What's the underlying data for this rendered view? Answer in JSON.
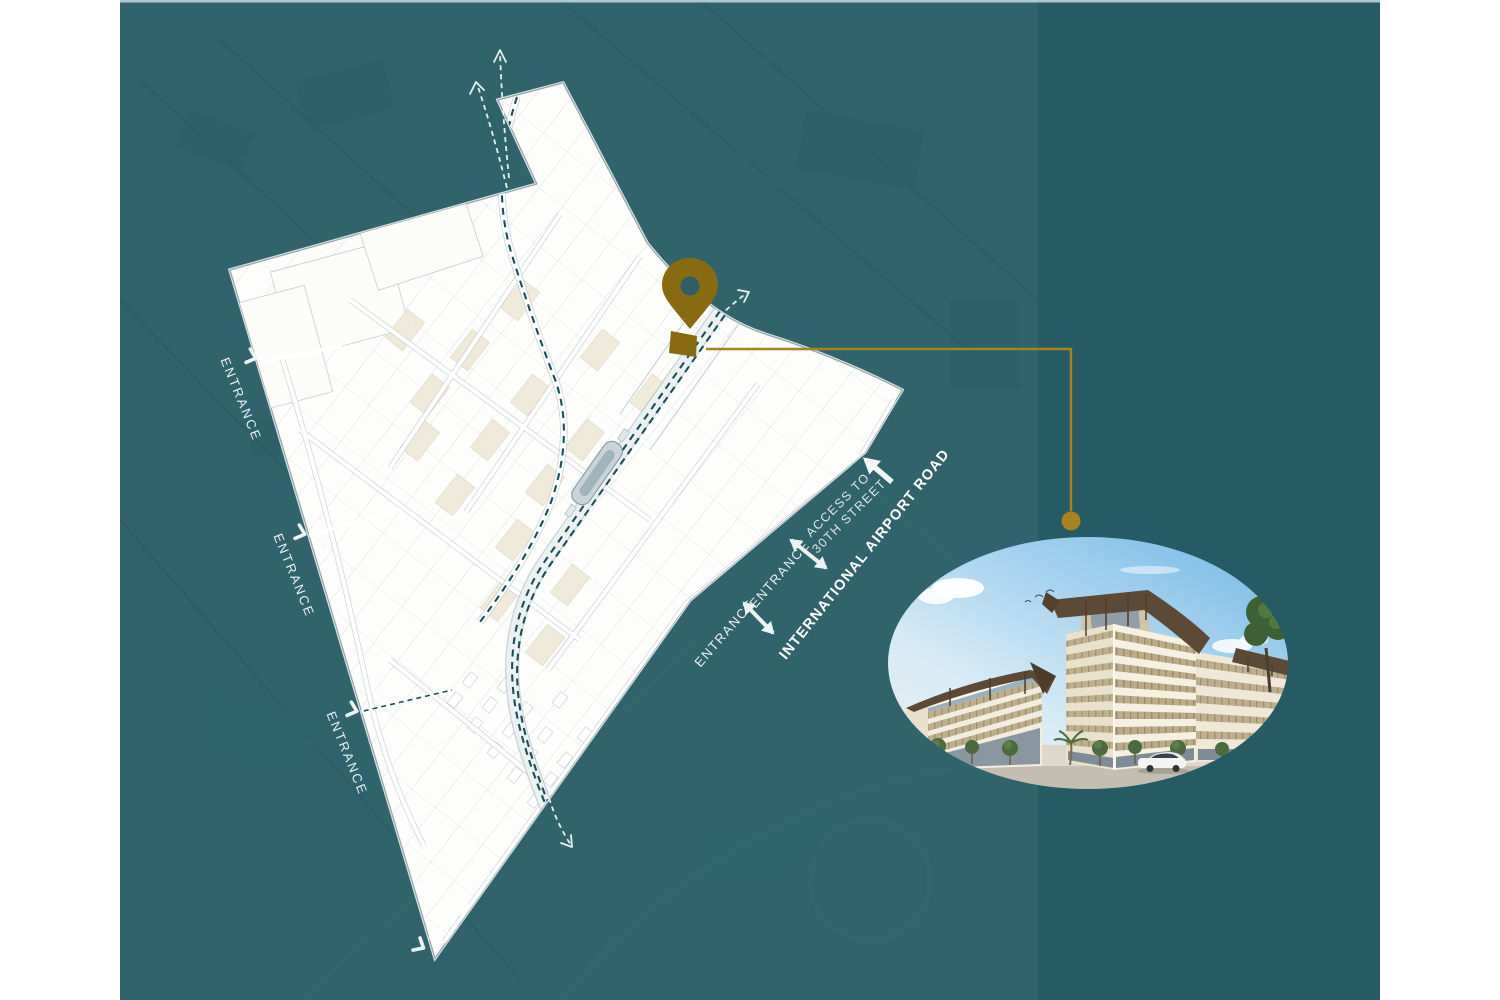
{
  "page": {
    "background": "#FFFFFF"
  },
  "canvas": {
    "base_teal": "#265B65",
    "overlay_light_teal": "#30626E",
    "top_border": "#C9D8DA"
  },
  "site_plan": {
    "entrances_left": [
      {
        "label": "ENTRANCE"
      },
      {
        "label": "ENTRANCE"
      },
      {
        "label": "ENTRANCE"
      }
    ],
    "entrances_right": [
      {
        "label": "ENTRANCE"
      },
      {
        "label": "ENTRANCE"
      }
    ],
    "access_road": {
      "line1": "ACCESS TO",
      "line2": "30TH STREET"
    },
    "airport_road": {
      "label": "INTERNATIONAL AIRPORT ROAD"
    }
  },
  "marker": {
    "pin_color": "#8A6A10",
    "plot_color": "#8A6A10",
    "connector_color": "#A6831E"
  },
  "icons": {
    "pin": "location-pin",
    "entrance_chevron": "chevron-right",
    "two_way_arrow": "double-headed-arrow",
    "access_arrow": "arrow-up-left",
    "route_arrows": "dashed-route-arrow"
  }
}
